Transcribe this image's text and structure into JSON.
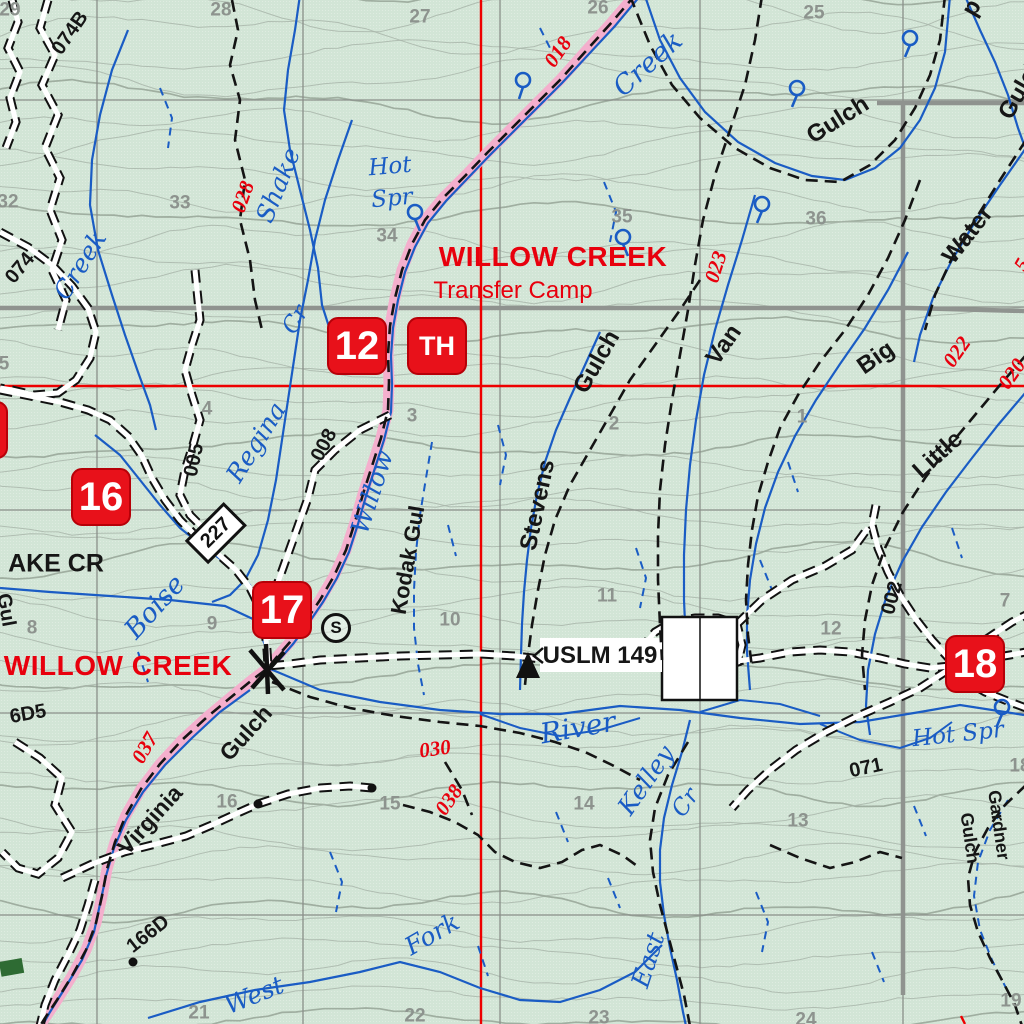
{
  "map_colors": {
    "background": "#d2e5d6",
    "red": "#e8000d",
    "water_blue": "#1a5cc4",
    "trail_pink": "#f4afcd",
    "contour_gray": "#a3b0a3",
    "section_gray": "#8d938e"
  },
  "places": {
    "willow_creek_camp": "WILLOW CREEK",
    "transfer_camp": "Transfer Camp",
    "willow_creek": "WILLOW CREEK",
    "ake_cr": "AKE CR",
    "uslm": "USLM 149"
  },
  "badges": [
    {
      "label": "12"
    },
    {
      "label": "TH"
    },
    {
      "label": "16"
    },
    {
      "label": "17"
    },
    {
      "label": "18"
    },
    {
      "label": ""
    }
  ],
  "trail_numbers": {
    "t018": "018",
    "t028": "028",
    "t023": "023",
    "t022": "022",
    "t020": "020",
    "t030": "030",
    "t037": "037",
    "t038": "038",
    "partial_right": "5"
  },
  "road_numbers": {
    "r074b": "074B",
    "r074": "074",
    "r005": "005",
    "r008": "008",
    "r227": "227",
    "r166d": "166D",
    "r66d5": "6D5",
    "r002": "002",
    "r071": "071"
  },
  "terrain_labels": {
    "gulch_ne": "Gulch",
    "gulch_ne_corner": "Gulch",
    "p_partial": "p",
    "water": "Water",
    "van": "Van",
    "big": "Big",
    "little": "Little",
    "stevens": "Stevens",
    "stevens_gulch": "Gulch",
    "kodak": "Kodak Gul",
    "virginia": "Virginia",
    "virginia_gulch": "Gulch",
    "gardner": "Gardner",
    "gardner_gulch": "Gulch",
    "left_partial": "Gul"
  },
  "water_labels": {
    "creek_nw": "Creek",
    "creek_ne": "Creek",
    "shake": "Shake",
    "regina": "Regina",
    "regina_cr": "Cr",
    "hot": "Hot",
    "spr": "Spr",
    "willow": "Willow",
    "boise": "Boise",
    "river": "River",
    "kelley": "Kelley",
    "kelley_cr": "Cr",
    "east": "East",
    "west": "West",
    "fork": "Fork",
    "hot_spr": "Hot Spr"
  },
  "symbols": {
    "s_marker": "S"
  },
  "sections": [
    {
      "n": "29"
    },
    {
      "n": "28"
    },
    {
      "n": "27"
    },
    {
      "n": "26"
    },
    {
      "n": "25"
    },
    {
      "n": "32"
    },
    {
      "n": "33"
    },
    {
      "n": "34"
    },
    {
      "n": "35"
    },
    {
      "n": "36"
    },
    {
      "n": "5"
    },
    {
      "n": "4"
    },
    {
      "n": "3"
    },
    {
      "n": "2"
    },
    {
      "n": "1"
    },
    {
      "n": "8"
    },
    {
      "n": "9"
    },
    {
      "n": "10"
    },
    {
      "n": "11"
    },
    {
      "n": "12"
    },
    {
      "n": "7"
    },
    {
      "n": "16"
    },
    {
      "n": "15"
    },
    {
      "n": "14"
    },
    {
      "n": "13"
    },
    {
      "n": "18"
    },
    {
      "n": "21"
    },
    {
      "n": "22"
    },
    {
      "n": "23"
    },
    {
      "n": "24"
    },
    {
      "n": "19"
    }
  ]
}
